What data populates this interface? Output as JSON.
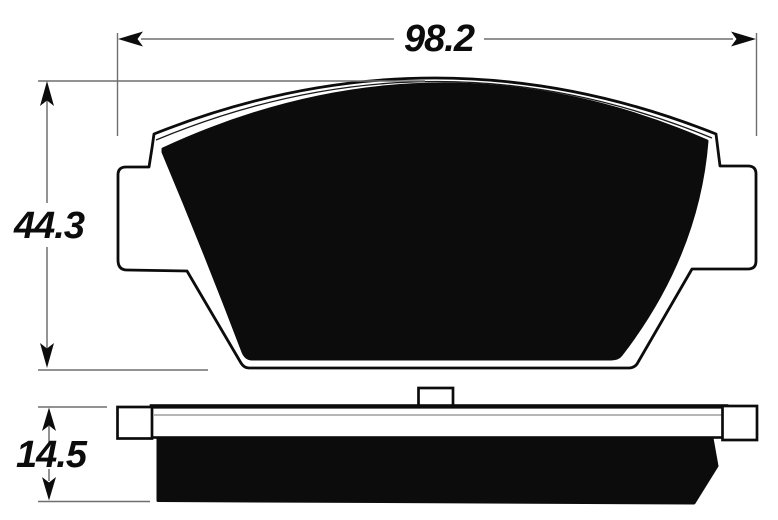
{
  "diagram": {
    "title": "Brake pad dimensioned technical drawing",
    "views": [
      {
        "id": "front",
        "name": "pad front profile with mounting ears"
      },
      {
        "id": "side",
        "name": "pad side profile: backing plate and friction material"
      }
    ],
    "dimensions": [
      {
        "id": "overall-width",
        "label": "98.2",
        "value": 98.2,
        "orientation": "horizontal",
        "applies_to": "front view total width"
      },
      {
        "id": "overall-height",
        "label": "44.3",
        "value": 44.3,
        "orientation": "vertical",
        "applies_to": "front view total height"
      },
      {
        "id": "overall-thickness",
        "label": "14.5",
        "value": 14.5,
        "orientation": "vertical",
        "applies_to": "side view total thickness"
      }
    ],
    "colors": {
      "ink": "#0c0c0c",
      "dimension_line": "#6f6f6f",
      "plate_detail_line": "#8a8a8a",
      "background": "#ffffff"
    }
  }
}
